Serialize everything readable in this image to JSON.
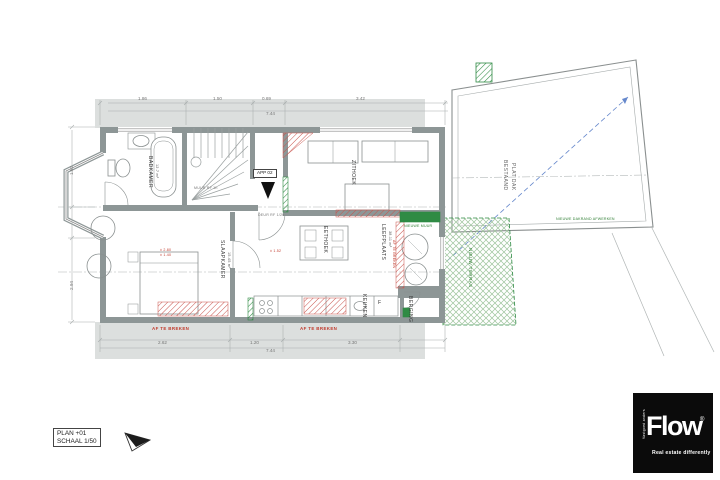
{
  "title_block": {
    "line1": "PLAN +01",
    "line2": "SCHAAL 1/50"
  },
  "logo": {
    "brand": "Flow",
    "registered": "®",
    "tagline": "Real estate differently",
    "side_text": "Vastgoed anders"
  },
  "rooms": {
    "badkamer": {
      "name": "BADKAMER",
      "area": "12.7 m²"
    },
    "slaapkamer": {
      "name": "SLAAPKAMER",
      "area": "15.45 m²"
    },
    "zithoek": {
      "name": "ZITHOEK"
    },
    "eethoek": {
      "name": "EETHOEK"
    },
    "keuken": {
      "name": "KEUKEN"
    },
    "leefplaats": {
      "name": "LEEFPLAATS",
      "area": "38.11 m²"
    },
    "berging": {
      "name": "BERGING"
    },
    "app_unit": {
      "name": "APP 02"
    }
  },
  "annotations": {
    "roof_line1": "BESTAAND",
    "roof_line2": "PLAT DAK",
    "terrace": "NIEUW TERRAS",
    "roof_edge": "NIEUWE DAKRAND AFWERKEN",
    "new_wall": "NIEUWE MUUR",
    "demolish_left": "AF TE BREKEN",
    "demolish_right": "AF TE BREKEN",
    "demolish_side": "AF TE BREKEN",
    "fire_wall": "MUUR RF 1h",
    "fire_door": "DEUR RF 1/2h",
    "fridge": "F",
    "red_dim_a": "± 2.80",
    "red_dim_b": "± 1.40",
    "red_dim_c": "± 1.52"
  },
  "dimensions": {
    "top": [
      "1.86",
      "1.50",
      "0.69",
      "3.42",
      "7.44"
    ],
    "left": [
      "1.62",
      "2.94"
    ],
    "bottom": [
      "2.62",
      "1.20",
      "3.30",
      "7.44"
    ]
  },
  "colors": {
    "wall": "#8d9696",
    "demolition": "#c9544d",
    "new": "#2f8b44",
    "slope": "#6688cc"
  }
}
